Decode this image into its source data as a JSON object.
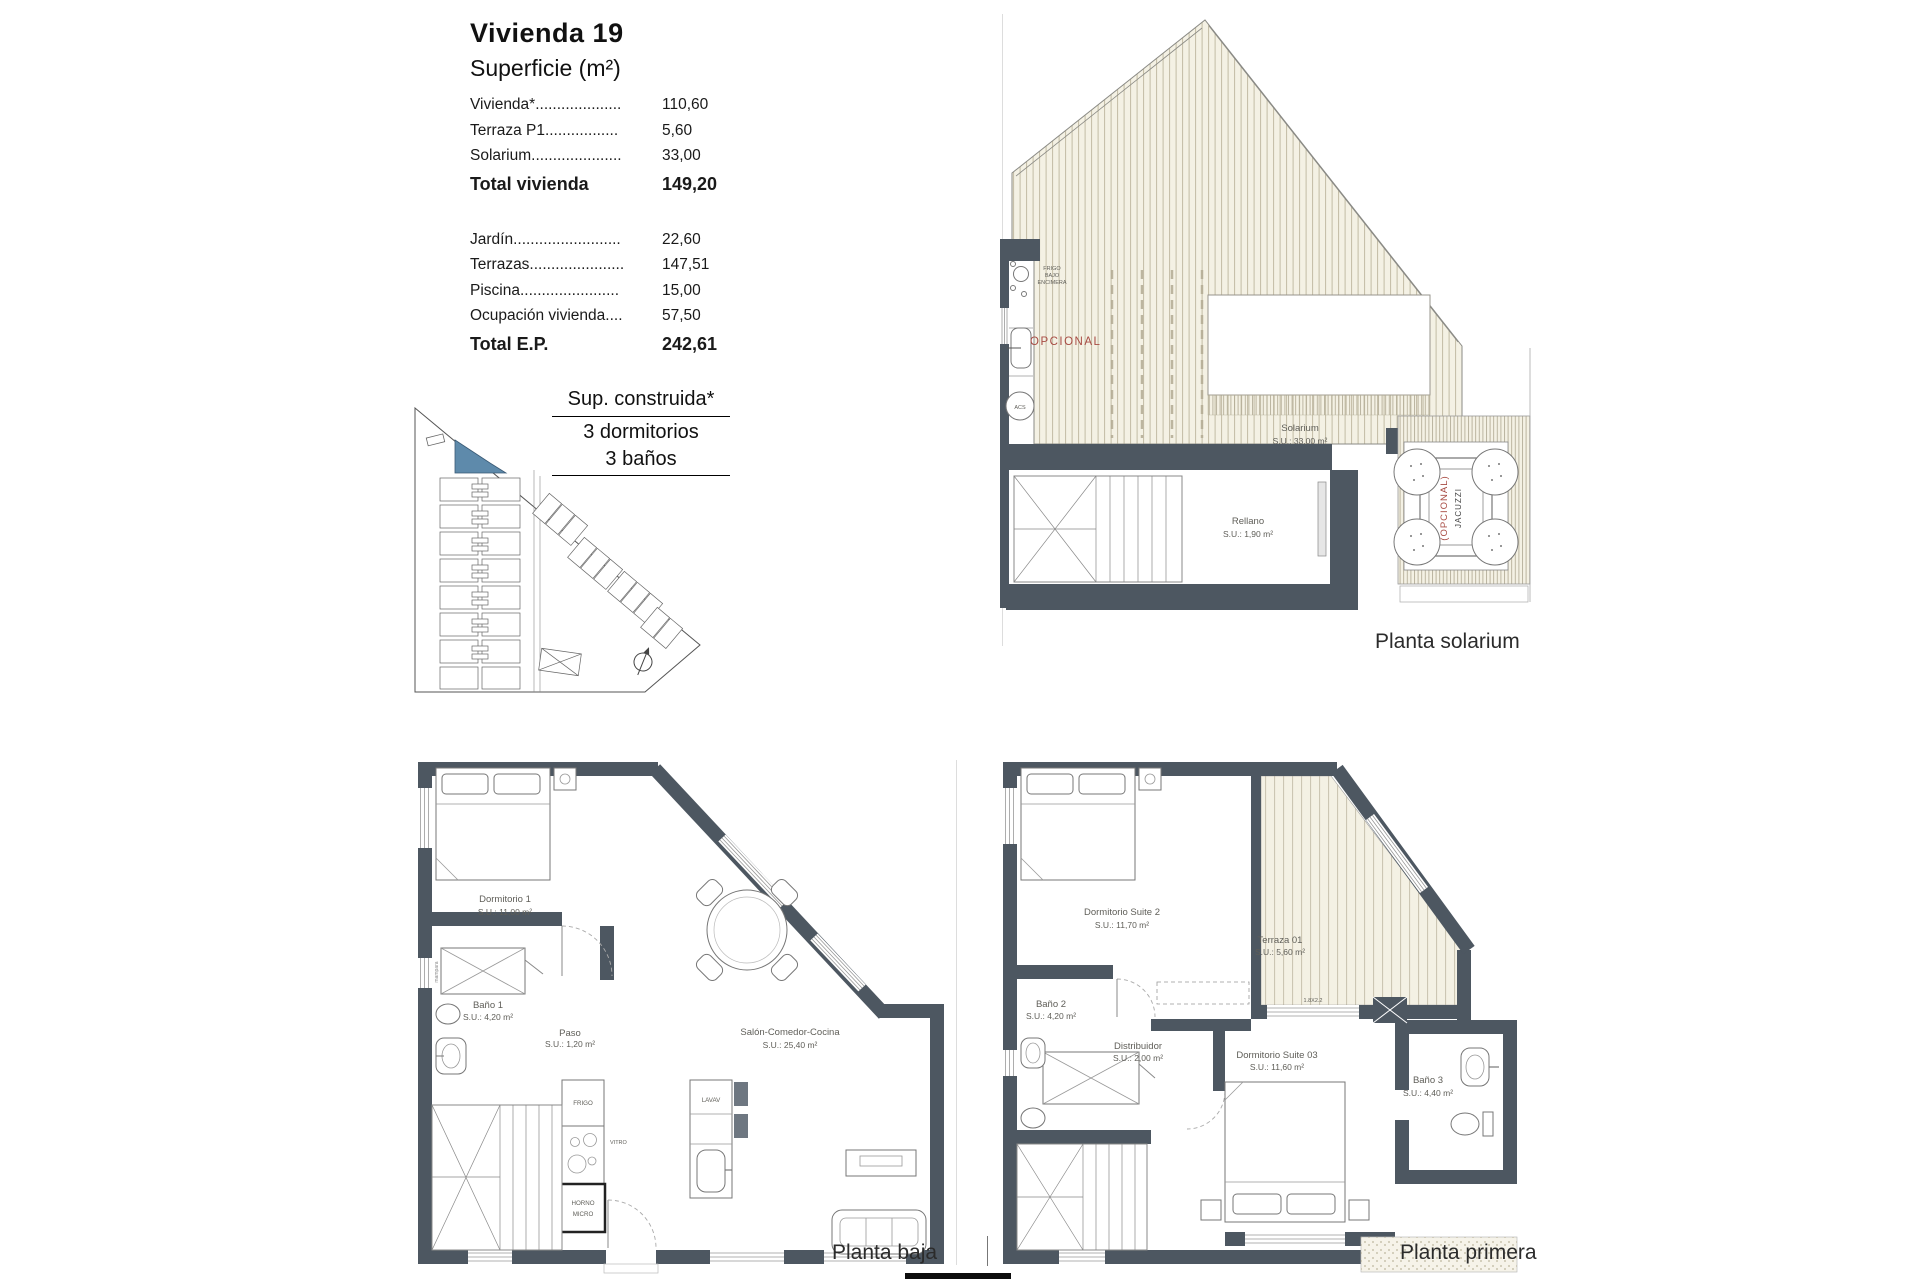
{
  "colors": {
    "wall": "#4d5761",
    "highlight_blue": "#5e8aab",
    "optional_red": "#a84c44",
    "deck_hatch": "#c2bba4"
  },
  "summary": {
    "title": "Vivienda 19",
    "subtitle": "Superficie (m²)",
    "rows": [
      {
        "label": "Vivienda*....................",
        "value": "110,60"
      },
      {
        "label": "Terraza P1.................",
        "value": "5,60"
      },
      {
        "label": "Solarium.....................",
        "value": "33,00"
      }
    ],
    "total_vivienda": {
      "label": "Total vivienda",
      "value": "149,20"
    },
    "rows2": [
      {
        "label": "Jardín.........................",
        "value": "22,60"
      },
      {
        "label": "Terrazas......................",
        "value": "147,51"
      },
      {
        "label": "Piscina.......................",
        "value": "15,00"
      },
      {
        "label": "Ocupación vivienda....",
        "value": "57,50"
      }
    ],
    "total_ep": {
      "label": "Total E.P.",
      "value": "242,61"
    }
  },
  "spec": {
    "line1": "Sup. construida*",
    "line2": "3 dormitorios",
    "line3": "3 baños"
  },
  "solarium": {
    "caption": "Planta solarium",
    "opcional": "OPCIONAL",
    "kitchenette": [
      "FRIGO",
      "BAJO",
      "ENCIMERA"
    ],
    "acs": "ACS",
    "solarium_room": {
      "name": "Solarium",
      "su": "S.U.: 33,00 m²"
    },
    "rellano": {
      "name": "Rellano",
      "su": "S.U.: 1,90 m²"
    },
    "jacuzzi": {
      "optional": "(OPCIONAL)",
      "name": "JACUZZI"
    }
  },
  "baja": {
    "caption": "Planta baja",
    "dormitorio1": {
      "name": "Dormitorio 1",
      "su": "S.U.: 11,00 m²"
    },
    "bano1": {
      "name": "Baño 1",
      "su": "S.U.: 4,20 m²"
    },
    "paso": {
      "name": "Paso",
      "su": "S.U.: 1,20 m²"
    },
    "salon": {
      "name": "Salón-Comedor-Cocina",
      "su": "S.U.: 25,40 m²"
    },
    "frigo": "FRIGO",
    "vitro": "VITRO",
    "lavav": "LAVAV",
    "horno": [
      "HORNO",
      "MICRO"
    ],
    "mampara": "mampara"
  },
  "primera": {
    "caption": "Planta primera",
    "suite2": {
      "name": "Dormitorio Suite 2",
      "su": "S.U.: 11,70 m²"
    },
    "terraza": {
      "name": "Terraza 01",
      "su": "S.U.: 5,60 m²"
    },
    "bano2": {
      "name": "Baño 2",
      "su": "S.U.: 4,20 m²"
    },
    "distribuidor": {
      "name": "Distribuidor",
      "su": "S.U.: 2,00 m²"
    },
    "suite3": {
      "name": "Dormitorio Suite 03",
      "su": "S.U.: 11,60 m²"
    },
    "bano3": {
      "name": "Baño 3",
      "su": "S.U.: 4,40 m²"
    },
    "window": "1.8X2.2"
  }
}
